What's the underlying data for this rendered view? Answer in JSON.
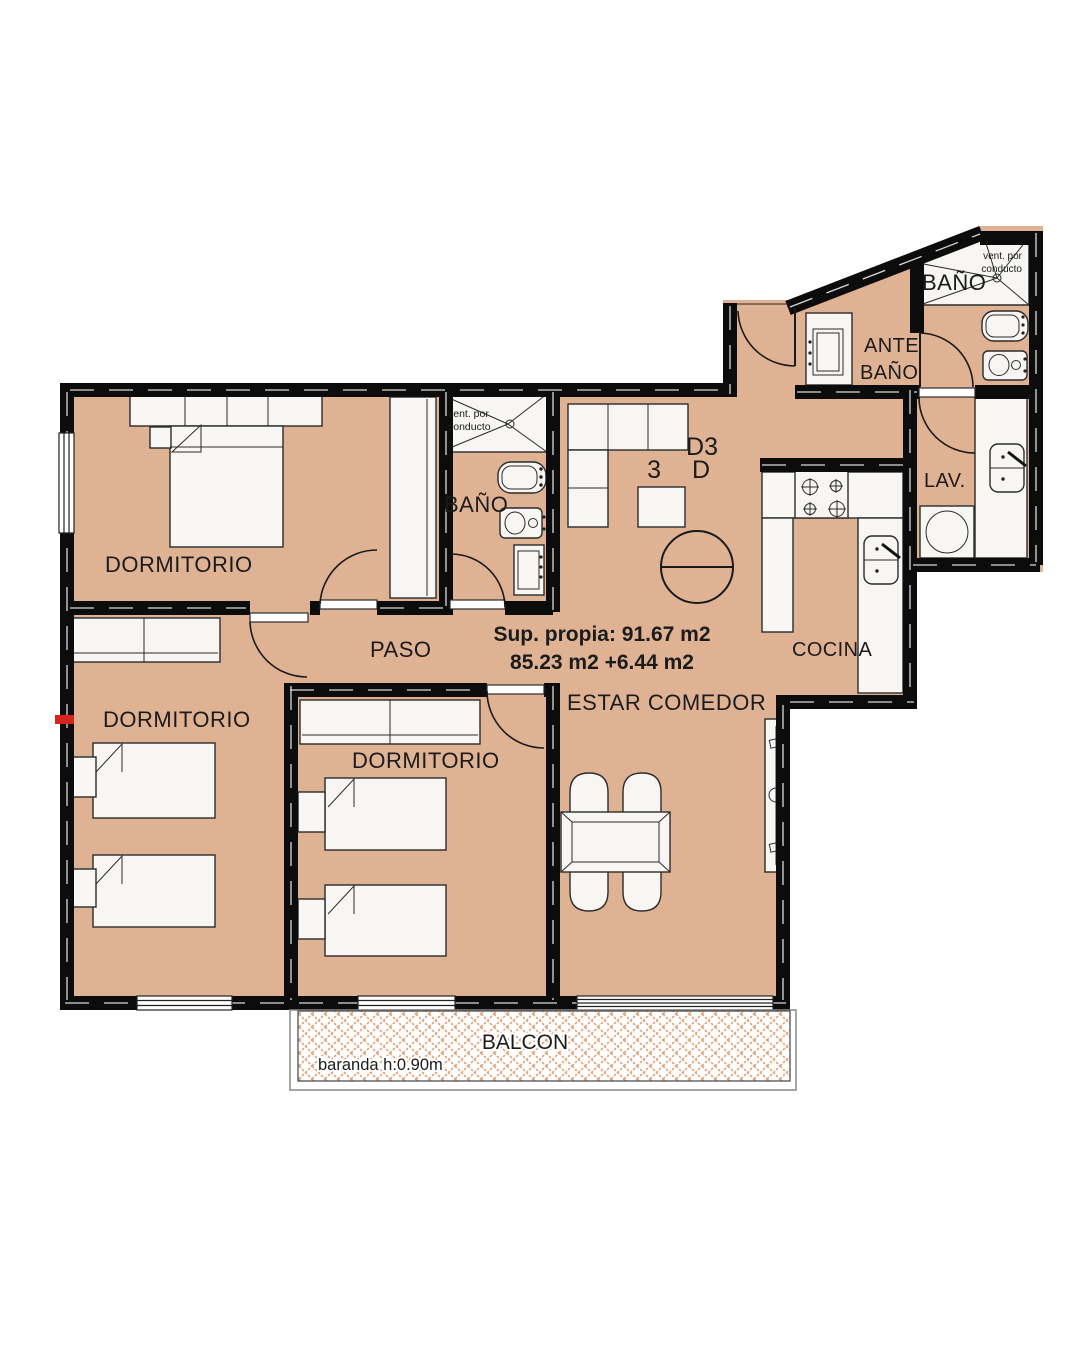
{
  "plan": {
    "unit": {
      "line1": "D3",
      "line2": "3 D"
    },
    "area": {
      "line1": "Sup. propia: 91.67 m2",
      "line2": "85.23 m2 +6.44 m2"
    },
    "rooms": {
      "dormitorio1": "DORMITORIO",
      "dormitorio2": "DORMITORIO",
      "dormitorio3": "DORMITORIO",
      "bano_mid": "BAÑO",
      "bano_top": "BAÑO",
      "antebano_line1": "ANTE",
      "antebano_line2": "BAÑO",
      "paso": "PASO",
      "estar": "ESTAR COMEDOR",
      "cocina": "COCINA",
      "lav": "LAV.",
      "balcon": "BALCON"
    },
    "notes": {
      "vent_mid_line1": "vent. por",
      "vent_mid_line2": "conducto",
      "vent_top_line1": "vent. por",
      "vent_top_line2": "conducto",
      "baranda": "baranda h:0.90m"
    },
    "colors": {
      "floor": "#dfb294",
      "wall": "#0c0c0c",
      "hatch": "#dfa67c",
      "accent_red": "#d4251c"
    }
  }
}
